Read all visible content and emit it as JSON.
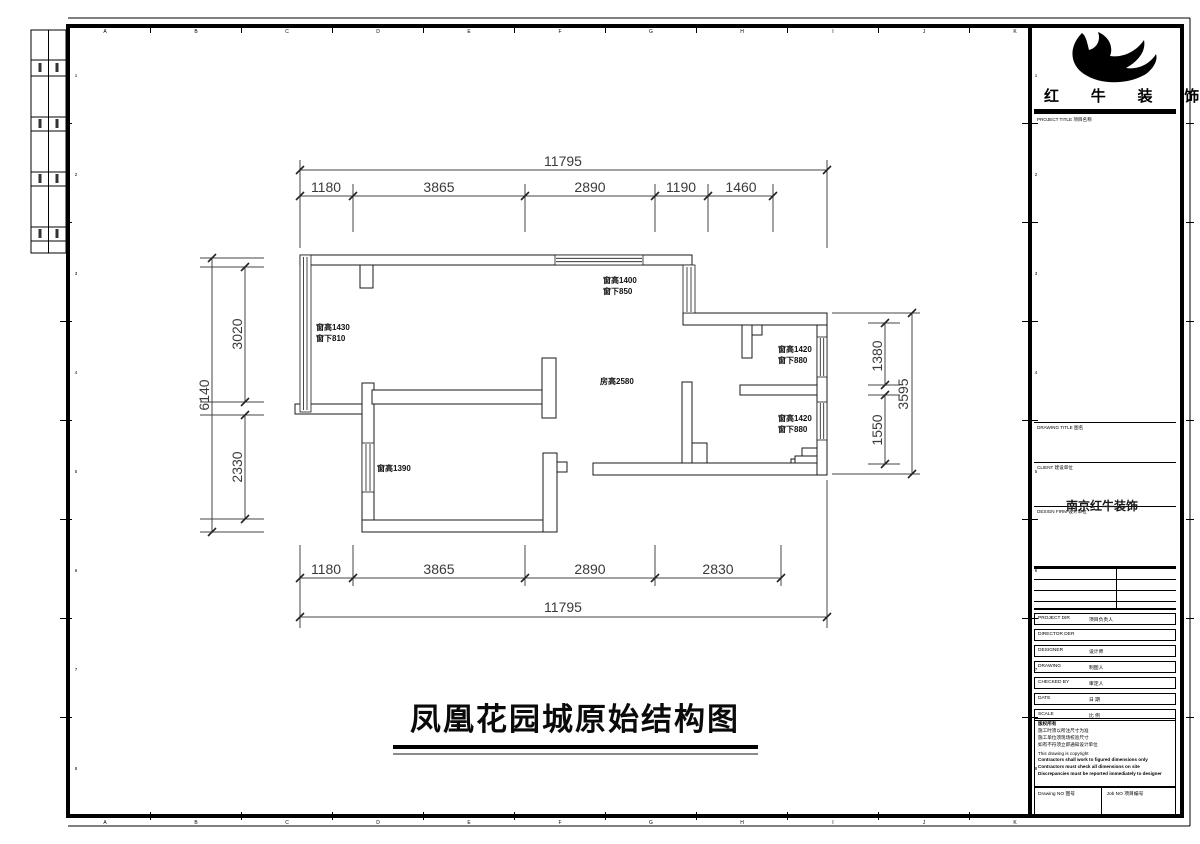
{
  "sheet": {
    "grid_letters": [
      "A",
      "B",
      "C",
      "D",
      "E",
      "F",
      "G",
      "H",
      "I",
      "J",
      "K"
    ],
    "grid_numbers": [
      "1",
      "2",
      "3",
      "4",
      "5",
      "6",
      "7",
      "8"
    ]
  },
  "plan": {
    "title": "凤凰花园城原始结构图",
    "room_label": "房高2580",
    "labels": {
      "win_left": {
        "l1": "窗高1430",
        "l2": "窗下810"
      },
      "win_top": {
        "l1": "窗高1400",
        "l2": "窗下850"
      },
      "win_right_upper": {
        "l1": "窗高1420",
        "l2": "窗下880"
      },
      "win_right_lower": {
        "l1": "窗高1420",
        "l2": "窗下880"
      },
      "win_bottom_left": {
        "l1": "窗高1390"
      }
    },
    "dimensions": {
      "top_overall": "11795",
      "top_segments": [
        "1180",
        "3865",
        "2890",
        "1190",
        "1460"
      ],
      "bottom_segments": [
        "1180",
        "3865",
        "2890",
        "2830"
      ],
      "bottom_overall": "11795",
      "left_overall": "6140",
      "left_segments": [
        "3020",
        "2330"
      ],
      "right_segments": [
        "1380",
        "1550"
      ],
      "right_overall": "3595"
    }
  },
  "title_block": {
    "company_name": "红 牛 装 饰",
    "logo_icon": "bull-swoosh-logo",
    "project_title_label": "PROJECT TITLE 项目名称",
    "drawing_title_label": "DRAWING TITLE 图名",
    "client_label": "CLIENT 建设单位",
    "design_firm_label": "DESIGN FIRM 设计单位",
    "design_firm_stamp": "南京红牛装饰",
    "rows": [
      {
        "en": "PROJECT DIR",
        "zh": "项目负责人"
      },
      {
        "en": "DIRECTOR DER",
        "zh": ""
      },
      {
        "en": "DESIGNER",
        "zh": "设计师"
      },
      {
        "en": "DRAWING",
        "zh": "制图人"
      },
      {
        "en": "CHECKED BY",
        "zh": "审定人"
      },
      {
        "en": "DATE",
        "zh": "日 期"
      },
      {
        "en": "SCALE",
        "zh": "比 例"
      }
    ],
    "copyright": {
      "zh": [
        "版权所有",
        "施工时须以所注尺寸为准",
        "施工单位须现场校验尺寸",
        "如有不符须立即通知设计单位"
      ],
      "en": "This drawing is copyright",
      "en_bold": [
        "Contractors shall work to figured dimensions only",
        "Contractors must check all dimensions on site",
        "Discrepancies must be reported immediately to designer"
      ]
    },
    "drawing_no_label": "Drawing NO 图号",
    "job_no_label": "Job NO 项目编号"
  }
}
